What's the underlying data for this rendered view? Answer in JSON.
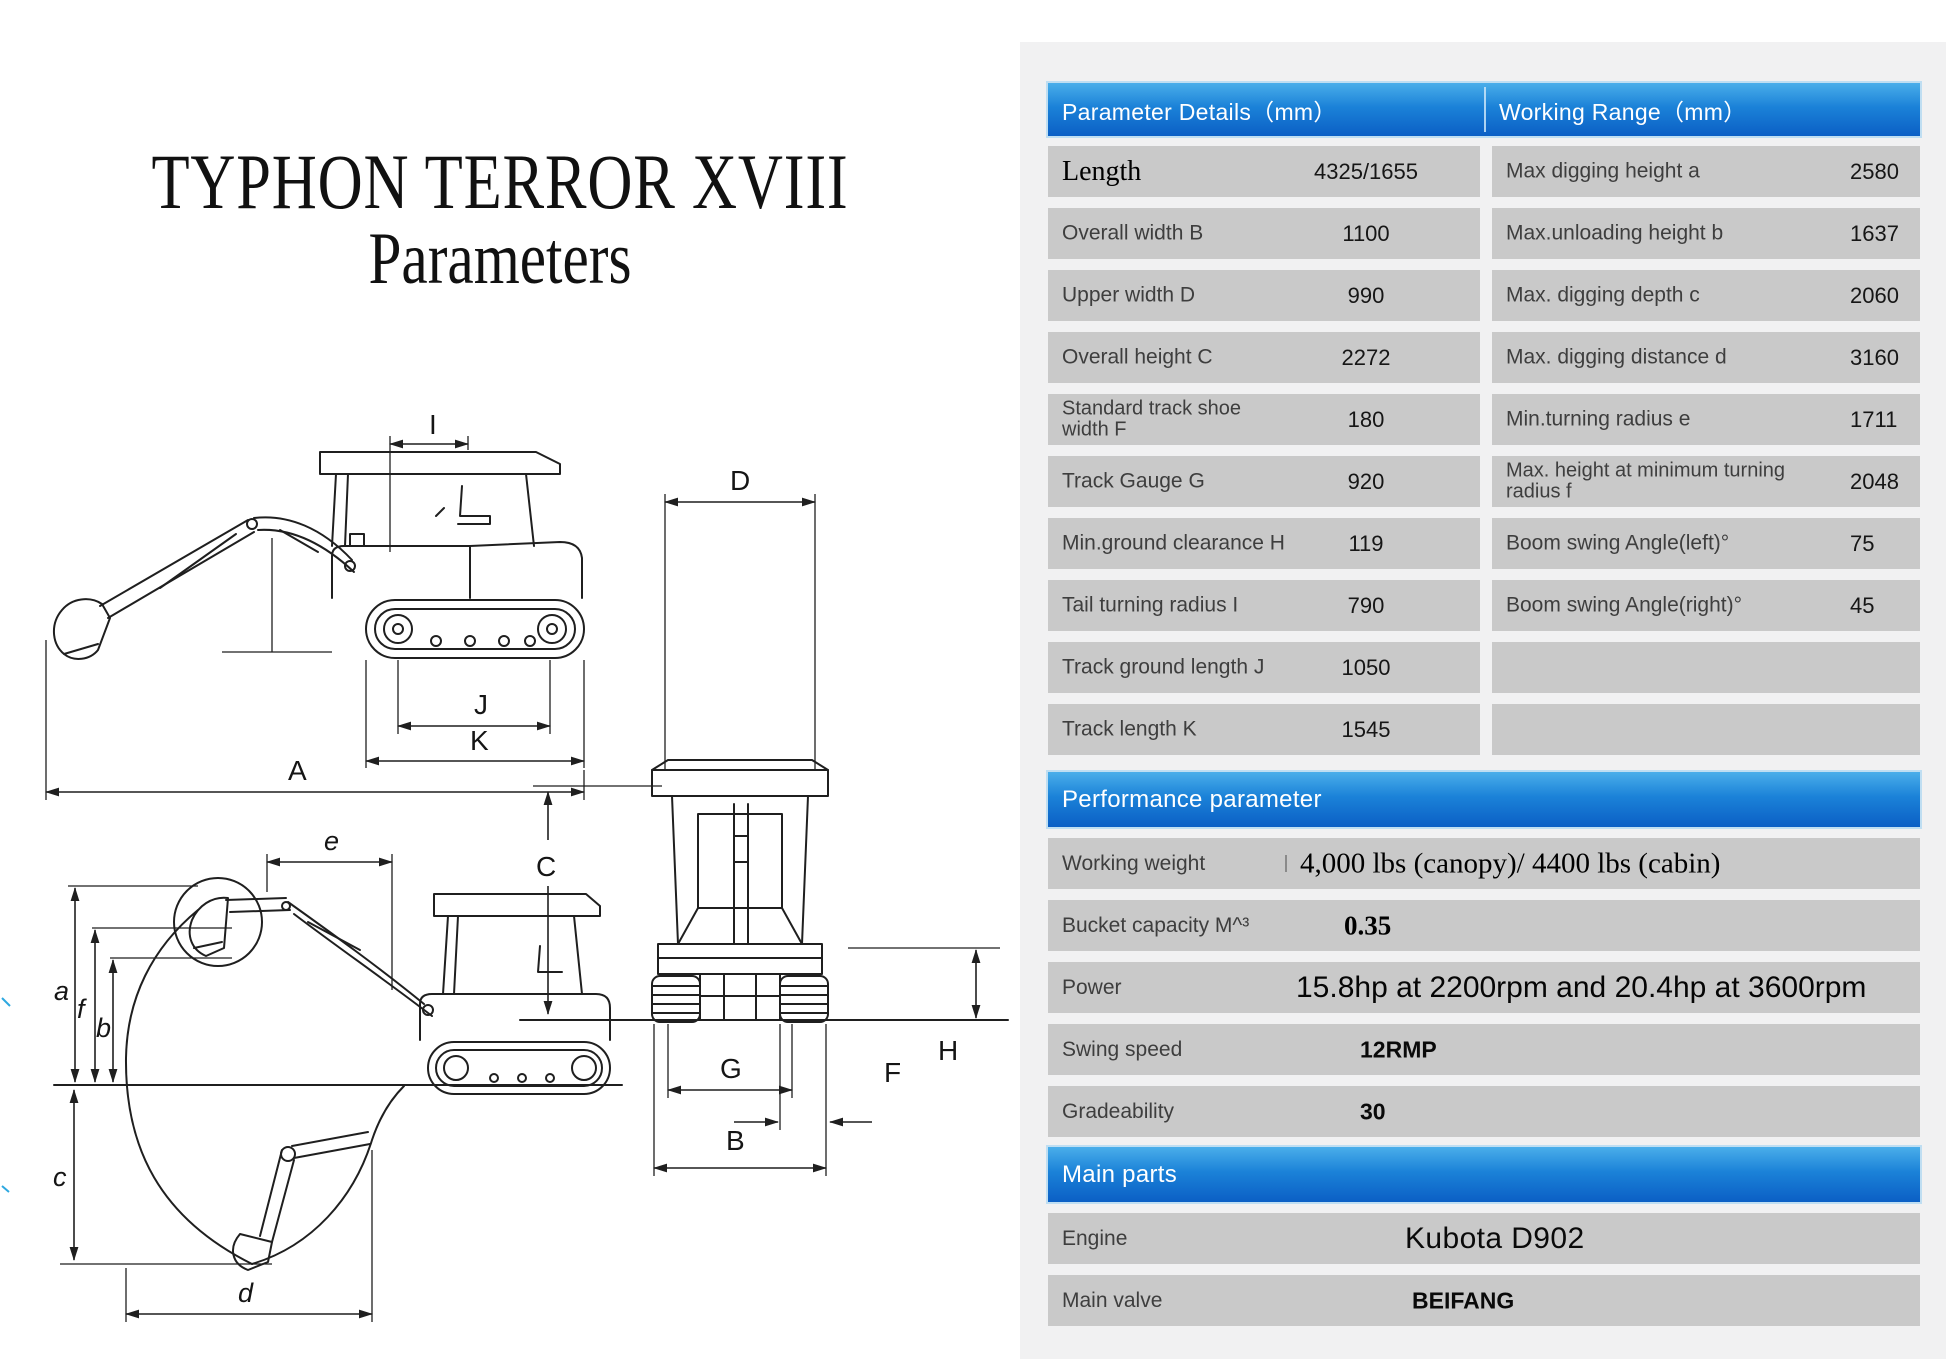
{
  "title": {
    "line1": "TYPHON TERROR XVIII",
    "line2": "Parameters"
  },
  "diagrams": {
    "side_view": {
      "labels": {
        "I": "I",
        "J": "J",
        "K": "K",
        "A": "A"
      }
    },
    "working_range": {
      "labels": {
        "e": "e",
        "a": "a",
        "f": "f",
        "b": "b",
        "c": "c",
        "d": "d"
      }
    },
    "front_view": {
      "labels": {
        "D": "D",
        "C": "C",
        "G": "G",
        "B": "B",
        "F": "F",
        "H": "H"
      }
    }
  },
  "spec_table": {
    "left_header": "Parameter Details（mm）",
    "right_header": "Working Range（mm）",
    "rows": [
      {
        "param": "Length",
        "param_value": "4325/1655",
        "range": "Max digging height a",
        "range_value": "2580"
      },
      {
        "param": "Overall width B",
        "param_value": "1100",
        "range": "Max.unloading height b",
        "range_value": "1637"
      },
      {
        "param": "Upper width D",
        "param_value": "990",
        "range": "Max. digging depth c",
        "range_value": "2060"
      },
      {
        "param": "Overall height C",
        "param_value": "2272",
        "range": "Max. digging distance d",
        "range_value": "3160"
      },
      {
        "param": "Standard track shoe width F",
        "param_value": "180",
        "range": "Min.turning radius e",
        "range_value": "1711"
      },
      {
        "param": "Track Gauge G",
        "param_value": "920",
        "range": "Max. height at minimum turning radius f",
        "range_value": "2048"
      },
      {
        "param": "Min.ground clearance H",
        "param_value": "119",
        "range": "Boom swing Angle(left)°",
        "range_value": "75"
      },
      {
        "param": "Tail turning radius I",
        "param_value": "790",
        "range": "Boom swing Angle(right)°",
        "range_value": "45"
      },
      {
        "param": "Track ground length J",
        "param_value": "1050",
        "range": "",
        "range_value": ""
      },
      {
        "param": "Track length K",
        "param_value": "1545",
        "range": "",
        "range_value": ""
      }
    ]
  },
  "performance": {
    "header": "Performance parameter",
    "rows": [
      {
        "label": "Working weight",
        "value": "4,000 lbs (canopy)/ 4400 lbs (cabin)"
      },
      {
        "label": "Bucket capacity M^³",
        "value": "0.35"
      },
      {
        "label": "Power",
        "value": "15.8hp at 2200rpm and 20.4hp at 3600rpm"
      },
      {
        "label": "Swing speed",
        "value": "12RMP"
      },
      {
        "label": "Gradeability",
        "value": "30"
      }
    ]
  },
  "main_parts": {
    "header": "Main parts",
    "rows": [
      {
        "label": "Engine",
        "value": "Kubota D902"
      },
      {
        "label": "Main valve",
        "value": "BEIFANG"
      }
    ]
  },
  "colors": {
    "header_blue_top": "#4aaeea",
    "header_blue_bottom": "#0b5fc5",
    "row_gray": "#c9c9c9",
    "panel_bg": "#f1f1f2",
    "line_ink": "#1f1f1f"
  }
}
